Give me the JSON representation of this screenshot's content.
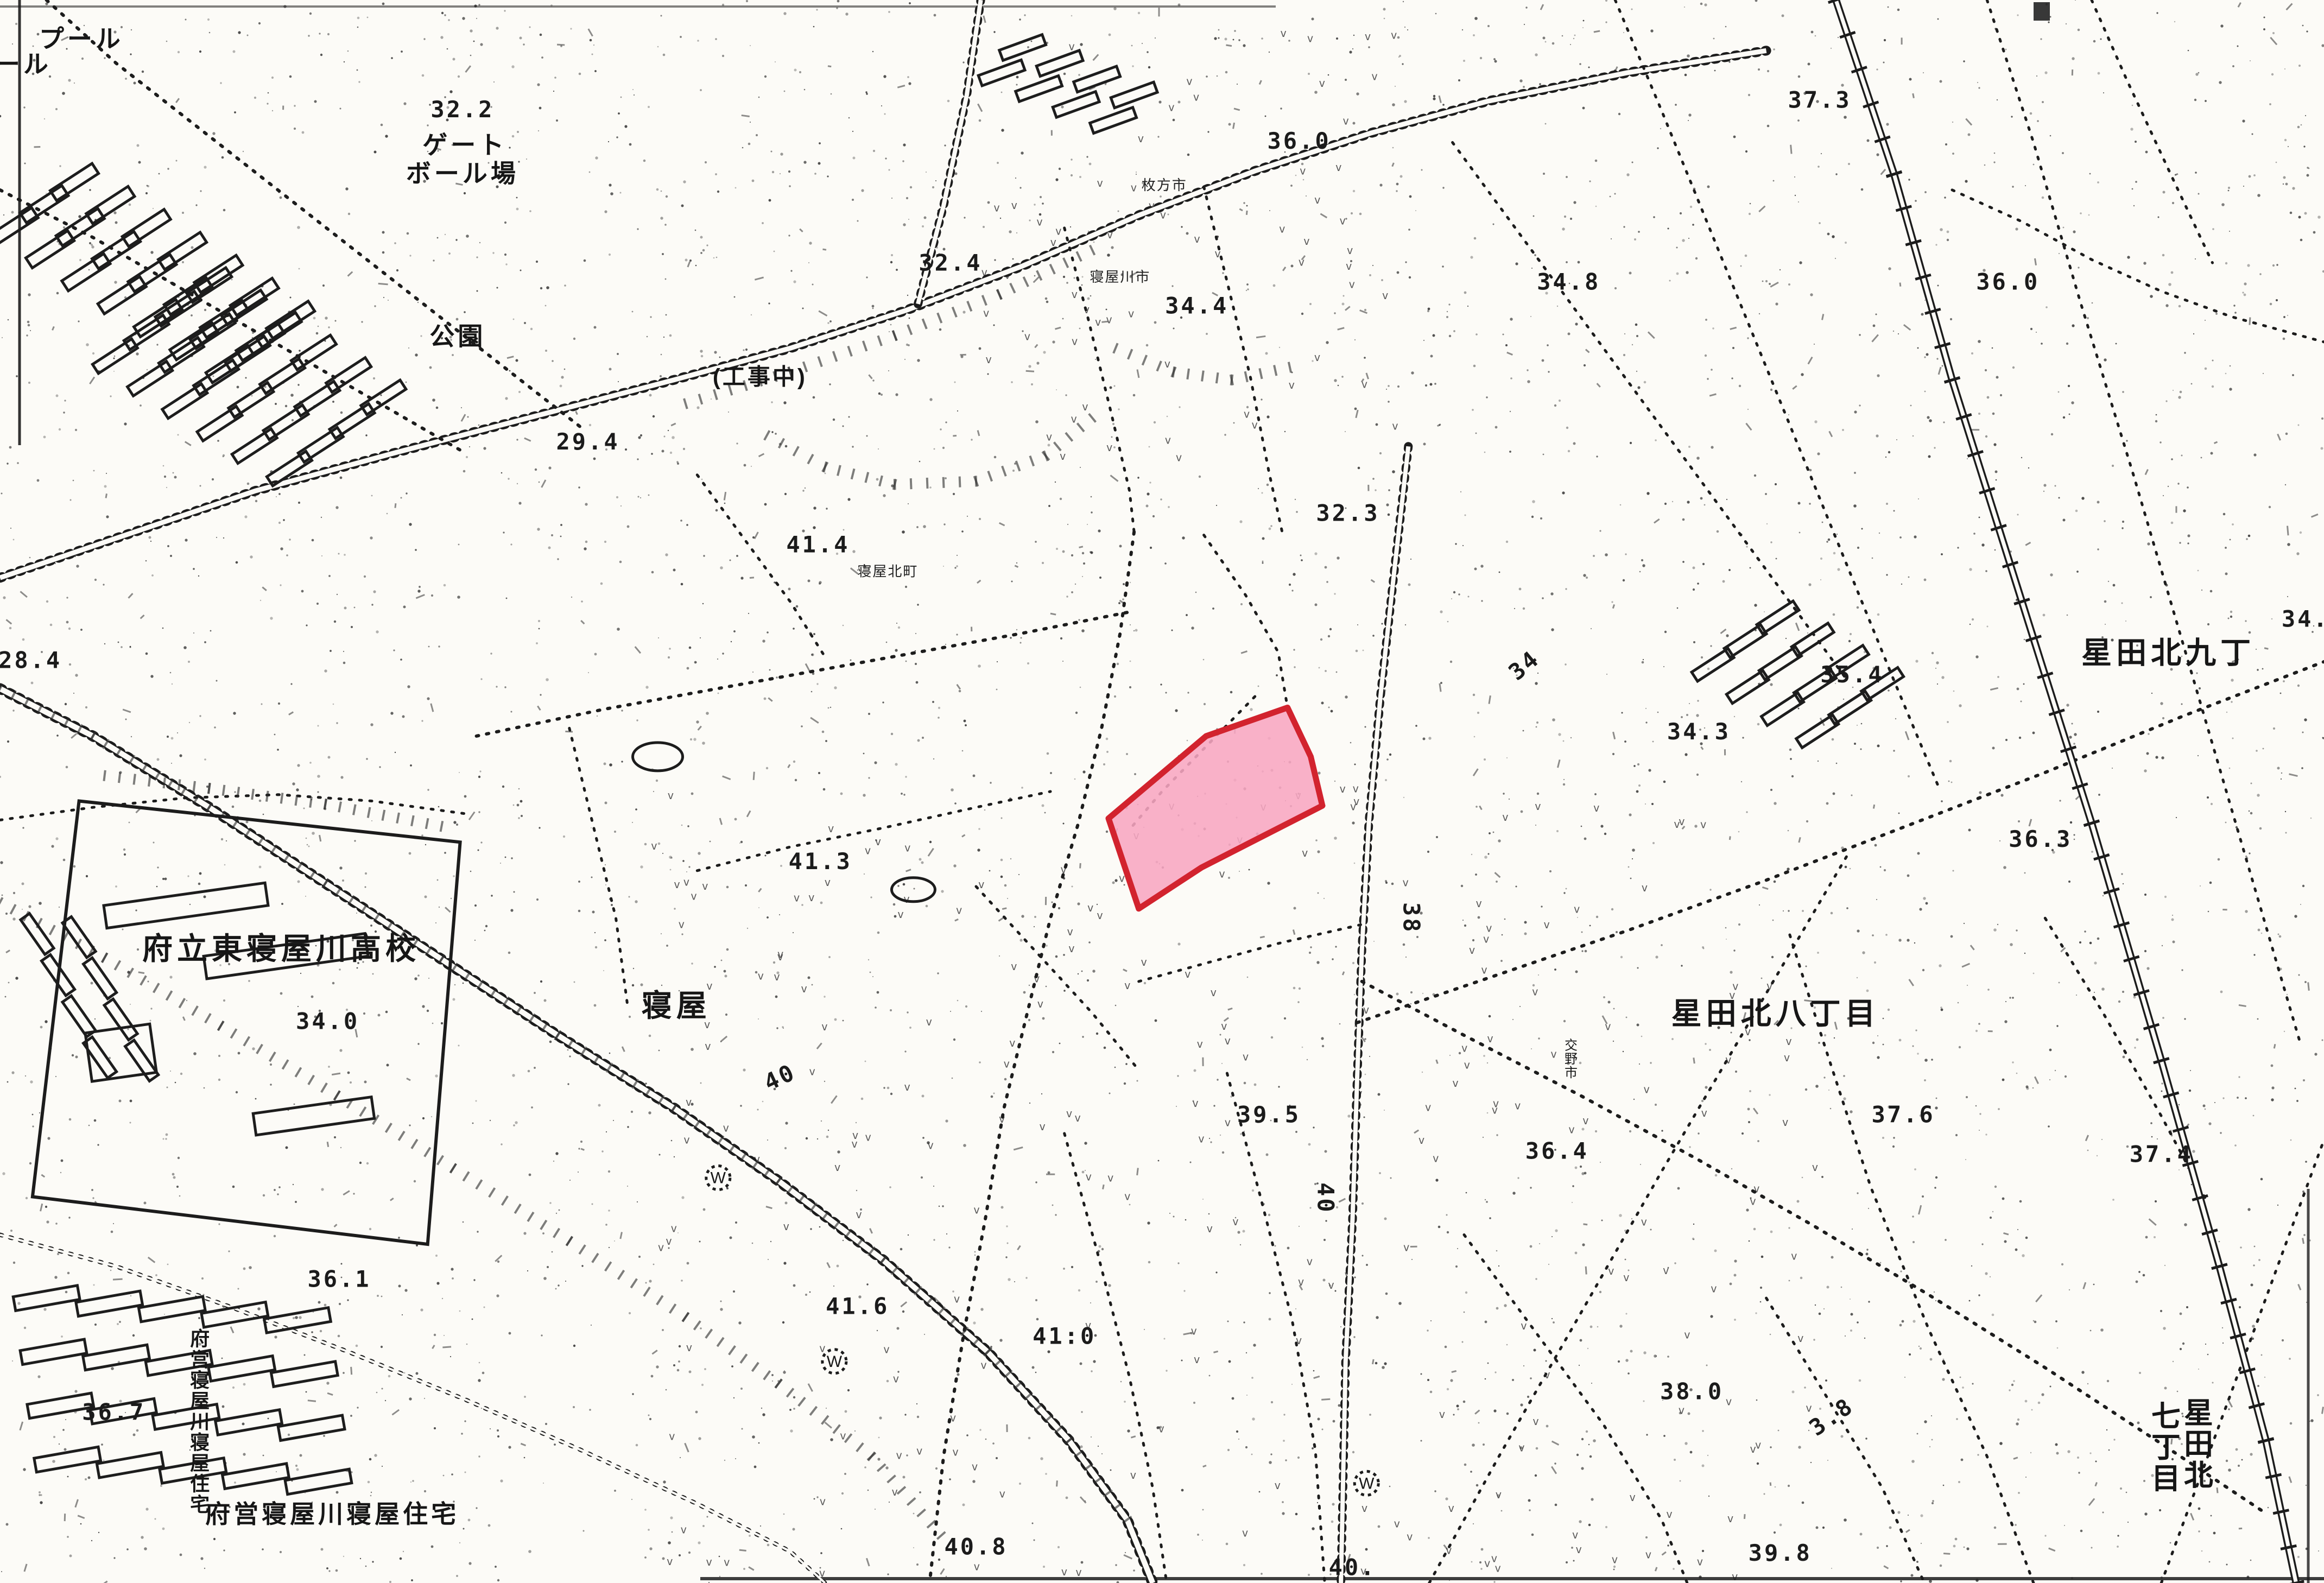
{
  "map": {
    "colors": {
      "paper": "#FCFBF7",
      "ink": "#1C1C1C",
      "highlight_fill": "#F8A6C1",
      "highlight_stroke": "#D2232E"
    },
    "highlight": {
      "name": "highlight-parcel",
      "points_pct": [
        [
          55.4,
          44.7
        ],
        [
          56.4,
          47.8
        ],
        [
          56.9,
          50.9
        ],
        [
          53.7,
          53.3
        ],
        [
          51.7,
          54.8
        ],
        [
          49.0,
          57.4
        ],
        [
          47.7,
          51.7
        ],
        [
          51.9,
          46.5
        ]
      ]
    },
    "well_glyph": "W",
    "wells": [
      [
        30.9,
        74.4
      ],
      [
        35.9,
        86.0
      ],
      [
        58.8,
        93.7
      ]
    ],
    "labels": [
      {
        "name": "pool-label",
        "text": "プール",
        "x": 3.5,
        "y": 3.0,
        "kind": "area-sm",
        "rot": 0
      },
      {
        "name": "pool-label-partial",
        "text": "ール",
        "x": 1.0,
        "y": 4.6,
        "kind": "area-sm",
        "rot": 0
      },
      {
        "name": "gateball-label-line1",
        "text": "ゲート",
        "x": 20.0,
        "y": 9.7,
        "kind": "area-sm",
        "rot": 0
      },
      {
        "name": "gateball-label-line2",
        "text": "ボール場",
        "x": 19.9,
        "y": 11.5,
        "kind": "area-sm",
        "rot": 0
      },
      {
        "name": "park-label",
        "text": "公園",
        "x": 19.7,
        "y": 21.8,
        "kind": "area-sm",
        "rot": 0
      },
      {
        "name": "under-construction-label",
        "text": "(工事中)",
        "x": 32.7,
        "y": 24.3,
        "kind": "paren",
        "rot": 0
      },
      {
        "name": "hirakata-city-label",
        "text": "枚方市",
        "x": 50.1,
        "y": 12.0,
        "kind": "tiny",
        "rot": 0
      },
      {
        "name": "neyagawa-city-label",
        "text": "寝屋川市",
        "x": 48.2,
        "y": 17.8,
        "kind": "tiny",
        "rot": 0
      },
      {
        "name": "neyakita-cho-label",
        "text": "寝屋北町",
        "x": 38.2,
        "y": 36.4,
        "kind": "tiny",
        "rot": 0
      },
      {
        "name": "katano-city-label",
        "text": "交野市",
        "x": 67.6,
        "y": 66.3,
        "kind": "tiny-vert",
        "rot": 0
      },
      {
        "name": "highschool-label",
        "text": "府立東寝屋川高校",
        "x": 12.1,
        "y": 60.6,
        "kind": "area-md",
        "rot": 0
      },
      {
        "name": "neya-label",
        "text": "寝屋",
        "x": 29.1,
        "y": 64.2,
        "kind": "area-md",
        "rot": 0
      },
      {
        "name": "hoshidakita-8chome-label",
        "text": "星田北八丁目",
        "x": 76.4,
        "y": 64.7,
        "kind": "area-md",
        "rot": 0
      },
      {
        "name": "hoshidakita-9cho-label",
        "text": "星田北九丁",
        "x": 93.3,
        "y": 41.9,
        "kind": "area-md",
        "rot": 0
      },
      {
        "name": "hoshidakita-7-col-right",
        "text": "星田北",
        "x": 94.6,
        "y": 89.9,
        "kind": "vert-md",
        "rot": 0
      },
      {
        "name": "hoshidakita-7-col-left",
        "text": "七丁目",
        "x": 93.2,
        "y": 90.1,
        "kind": "vert-md",
        "rot": 0
      },
      {
        "name": "fuei-jutaku-vertical-label",
        "text": "府営寝屋川寝屋住宅",
        "x": 8.6,
        "y": 85.0,
        "kind": "vert",
        "rot": 0
      },
      {
        "name": "fuei-jutaku-horizontal-label",
        "text": "府営寝屋川寝屋住宅",
        "x": 14.3,
        "y": 96.2,
        "kind": "area-sm",
        "rot": 0
      },
      {
        "name": "spot-elevation",
        "text": "32.2",
        "x": 19.9,
        "y": 7.4,
        "kind": "elev",
        "rot": 0
      },
      {
        "name": "spot-elevation",
        "text": "29.4",
        "x": 25.3,
        "y": 28.4,
        "kind": "elev",
        "rot": 0
      },
      {
        "name": "spot-elevation",
        "text": "32.4",
        "x": 40.9,
        "y": 17.1,
        "kind": "elev",
        "rot": 0
      },
      {
        "name": "spot-elevation",
        "text": "34.4",
        "x": 51.5,
        "y": 19.8,
        "kind": "elev",
        "rot": 0
      },
      {
        "name": "spot-elevation",
        "text": "36.0",
        "x": 55.9,
        "y": 9.4,
        "kind": "elev",
        "rot": 0
      },
      {
        "name": "spot-elevation",
        "text": "37.3",
        "x": 78.3,
        "y": 6.8,
        "kind": "elev",
        "rot": 0
      },
      {
        "name": "spot-elevation",
        "text": "34.8",
        "x": 67.5,
        "y": 18.3,
        "kind": "elev",
        "rot": 0
      },
      {
        "name": "spot-elevation",
        "text": "36.0",
        "x": 86.4,
        "y": 18.3,
        "kind": "elev",
        "rot": 0
      },
      {
        "name": "spot-elevation",
        "text": "35.4",
        "x": 79.7,
        "y": 43.1,
        "kind": "elev",
        "rot": 0
      },
      {
        "name": "spot-elevation",
        "text": "32.3",
        "x": 58.0,
        "y": 32.9,
        "kind": "elev",
        "rot": 0
      },
      {
        "name": "spot-elevation",
        "text": "41.4",
        "x": 35.2,
        "y": 34.9,
        "kind": "elev",
        "rot": 0
      },
      {
        "name": "spot-elevation",
        "text": "34.3",
        "x": 73.1,
        "y": 46.7,
        "kind": "elev",
        "rot": 0
      },
      {
        "name": "spot-elevation",
        "text": "36.3",
        "x": 87.8,
        "y": 53.5,
        "kind": "elev",
        "rot": 0
      },
      {
        "name": "spot-elevation",
        "text": "34.",
        "x": 99.2,
        "y": 39.6,
        "kind": "elev",
        "rot": 0
      },
      {
        "name": "spot-elevation",
        "text": "28.4",
        "x": 1.3,
        "y": 42.2,
        "kind": "elev",
        "rot": 0
      },
      {
        "name": "spot-elevation",
        "text": "41.3",
        "x": 35.3,
        "y": 54.9,
        "kind": "elev",
        "rot": 0
      },
      {
        "name": "spot-elevation",
        "text": "34.0",
        "x": 14.1,
        "y": 65.0,
        "kind": "elev",
        "rot": 0
      },
      {
        "name": "spot-elevation",
        "text": "39.5",
        "x": 54.6,
        "y": 70.9,
        "kind": "elev",
        "rot": 0
      },
      {
        "name": "spot-elevation",
        "text": "36.4",
        "x": 67.0,
        "y": 73.2,
        "kind": "elev",
        "rot": 0
      },
      {
        "name": "spot-elevation",
        "text": "37.6",
        "x": 81.9,
        "y": 70.9,
        "kind": "elev",
        "rot": 0
      },
      {
        "name": "spot-elevation",
        "text": "37.4",
        "x": 93.0,
        "y": 73.4,
        "kind": "elev",
        "rot": 0
      },
      {
        "name": "spot-elevation",
        "text": "36.1",
        "x": 14.6,
        "y": 81.3,
        "kind": "elev",
        "rot": 0
      },
      {
        "name": "spot-elevation",
        "text": "36.7",
        "x": 4.9,
        "y": 89.7,
        "kind": "elev",
        "rot": 0
      },
      {
        "name": "spot-elevation",
        "text": "41.6",
        "x": 36.9,
        "y": 83.0,
        "kind": "elev",
        "rot": 0
      },
      {
        "name": "spot-elevation",
        "text": "41:0",
        "x": 45.8,
        "y": 84.9,
        "kind": "elev",
        "rot": 0
      },
      {
        "name": "spot-elevation",
        "text": "40.8",
        "x": 42.0,
        "y": 98.2,
        "kind": "elev",
        "rot": 0
      },
      {
        "name": "spot-elevation",
        "text": "40.",
        "x": 58.2,
        "y": 99.5,
        "kind": "elev",
        "rot": 0
      },
      {
        "name": "spot-elevation",
        "text": "38.0",
        "x": 72.8,
        "y": 88.4,
        "kind": "elev",
        "rot": 0
      },
      {
        "name": "spot-elevation",
        "text": "39.8",
        "x": 76.6,
        "y": 98.6,
        "kind": "elev",
        "rot": 0
      },
      {
        "name": "contour-value",
        "text": "34",
        "x": 65.8,
        "y": 42.4,
        "kind": "elev",
        "rot": -40
      },
      {
        "name": "contour-value",
        "text": "38",
        "x": 60.4,
        "y": 58.0,
        "kind": "elev",
        "rot": 90
      },
      {
        "name": "contour-value",
        "text": "40",
        "x": 33.7,
        "y": 68.5,
        "kind": "elev",
        "rot": -25
      },
      {
        "name": "contour-value",
        "text": "40",
        "x": 56.7,
        "y": 75.7,
        "kind": "elev",
        "rot": 90
      },
      {
        "name": "contour-value",
        "text": "3.8",
        "x": 79.0,
        "y": 89.9,
        "kind": "elev",
        "rot": -35
      }
    ]
  }
}
